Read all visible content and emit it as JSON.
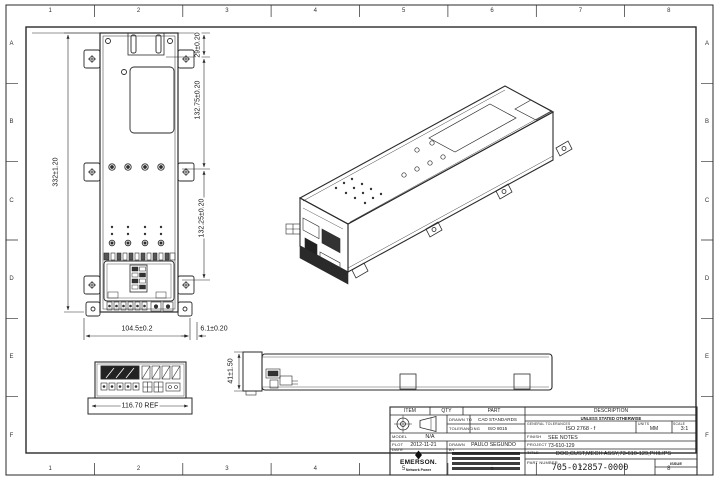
{
  "page": {
    "background": "#ffffff",
    "line_color": "#2a2a2a"
  },
  "zones": {
    "columns": [
      "1",
      "2",
      "3",
      "4",
      "5",
      "6",
      "7",
      "8"
    ],
    "rows": [
      "A",
      "B",
      "C",
      "D",
      "E",
      "F"
    ]
  },
  "views": {
    "front": {
      "dim_height": "332±1.20",
      "dim_top": "29±0.20",
      "dim_upper": "132.75±0.20",
      "dim_lower": "132.25±0.20",
      "dim_width": "104.5±0.2",
      "dim_offset": "6.1±0.20"
    },
    "side": {
      "dim_height": "41±1.50"
    },
    "detail": {
      "dim_width": "116.70 REF"
    }
  },
  "title_block": {
    "item_label": "ITEM",
    "qty_label": "QTY",
    "part_label": "PART",
    "description_label": "DESCRIPTION",
    "drawn_to_label": "DRAWN TO",
    "drawn_to_value": "CAD STANDARDS",
    "tolerancing_label": "TOLERANCING",
    "tolerancing_value": "ISO 8015",
    "unless_band": "UNLESS STATED OTHERWISE",
    "general_tol_label": "GENERAL TOLERANCES",
    "general_tol_value": "ISO 2768 - f",
    "units_label": "UNITS",
    "units_value": "MM",
    "scale_label": "SCALE",
    "scale_value": "3:1",
    "model_label": "MODEL",
    "model_value": "N/A",
    "plot_date_label": "PLOT DATE",
    "plot_date_value": "2012-11-21",
    "drawn_by_label": "DRAWN BY",
    "drawn_by_value": "PAULO SEGUNDO",
    "finish_label": "FINISH",
    "finish_value": "SEE NOTES",
    "project_label": "PROJECT",
    "project_value": "73-610-129",
    "title_label": "TITLE",
    "title_value": "DOC,CUST,MECH ASSY,73-610-129,PHILIPS",
    "part_number_label": "PART NUMBER",
    "part_number_value": "705-012857-0000",
    "issue_label": "ISSUE",
    "logo_text": "EMERSON.",
    "logo_subtext": "Network Power"
  }
}
